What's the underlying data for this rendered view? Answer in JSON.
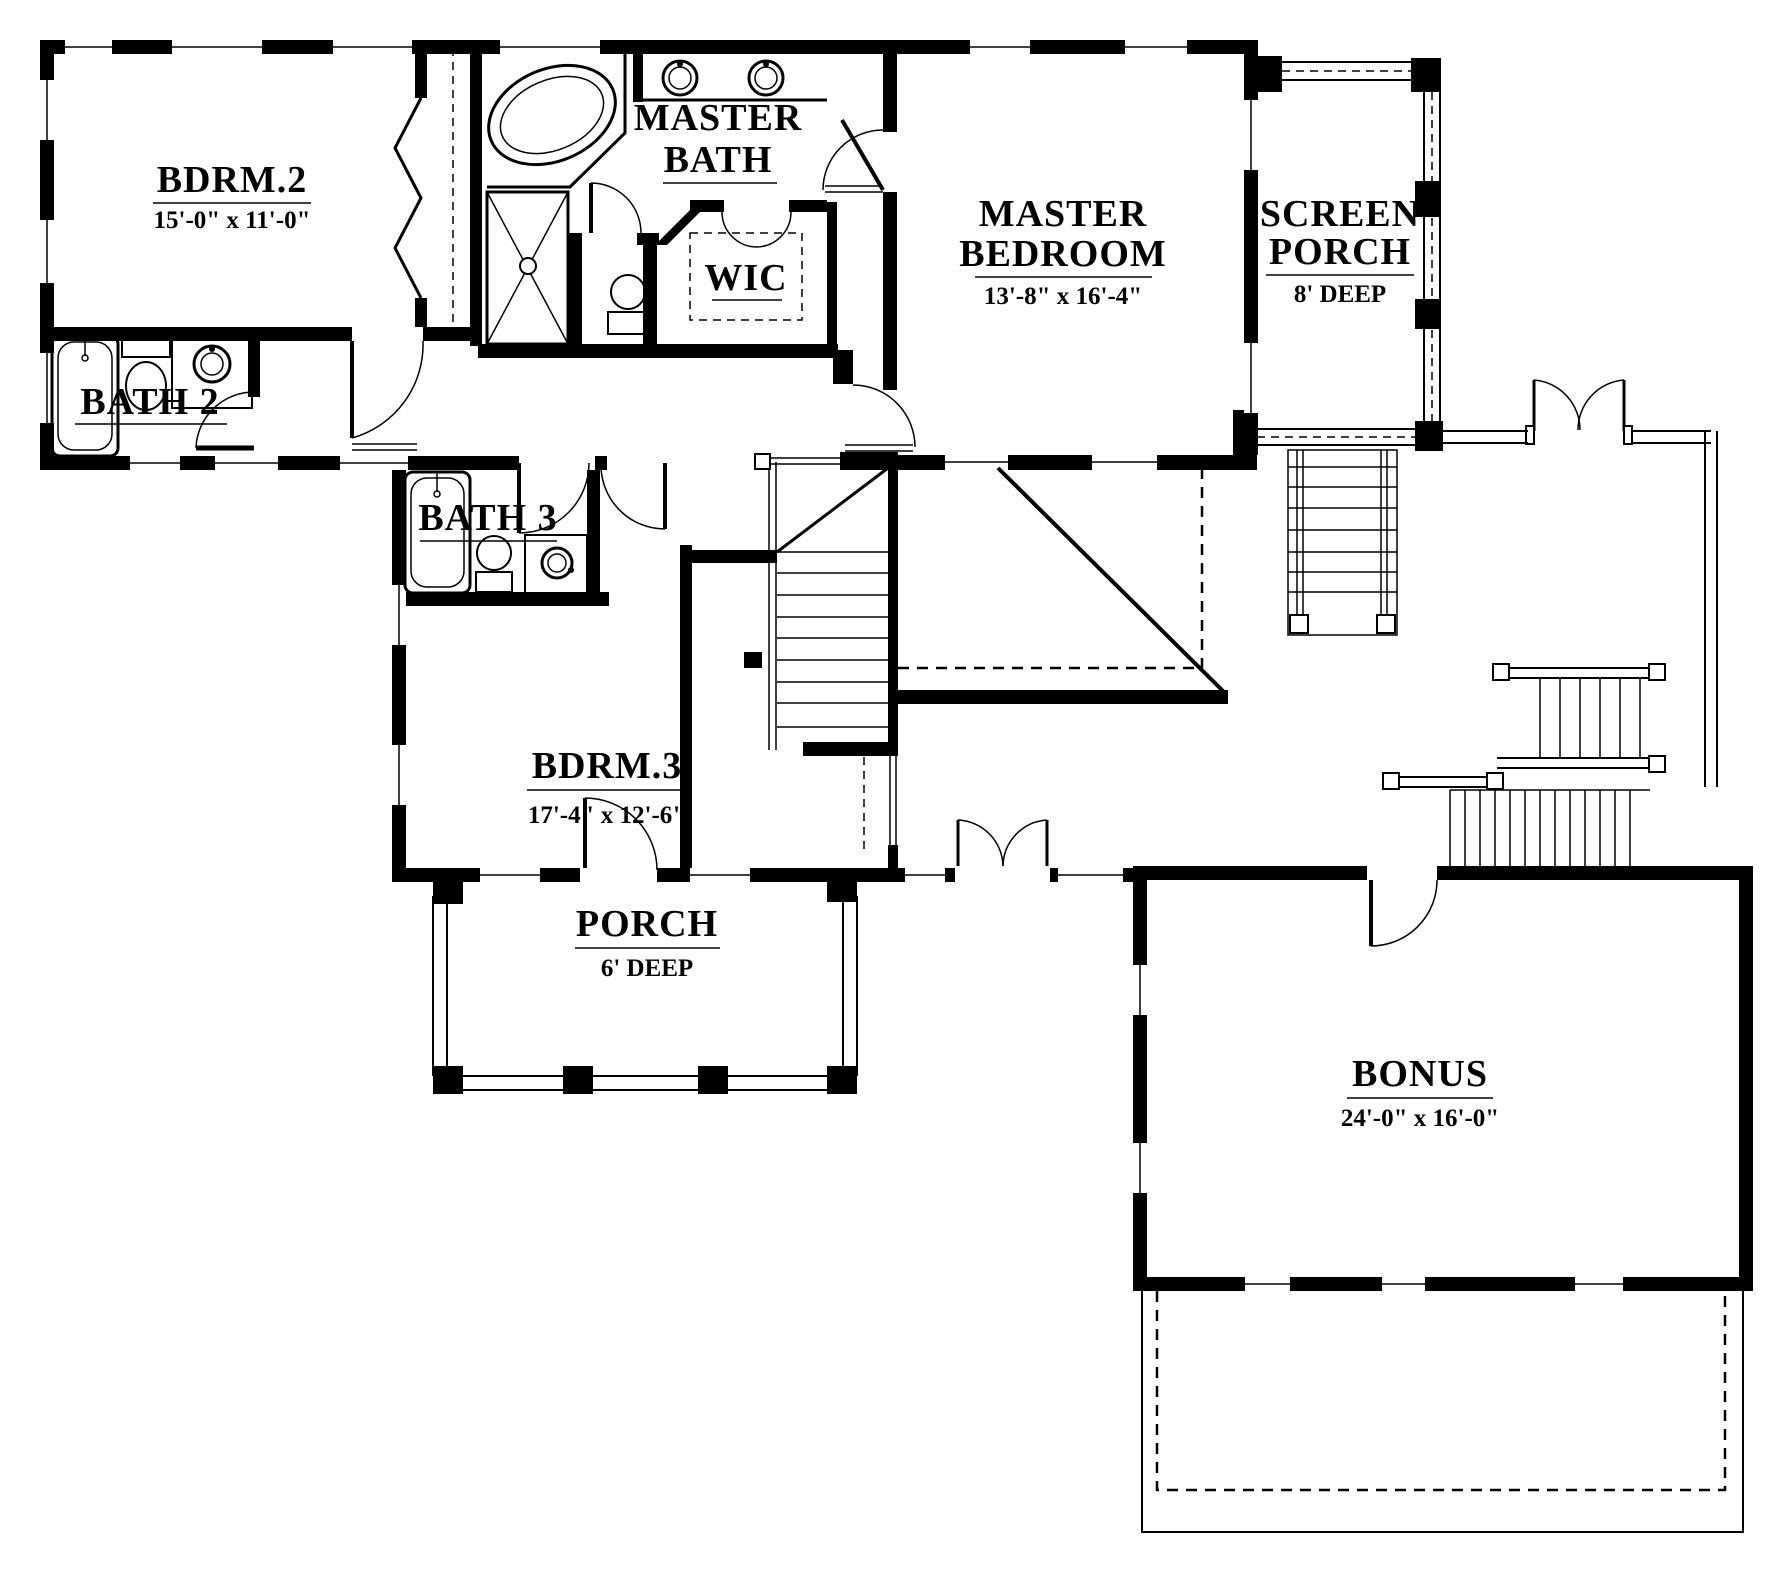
{
  "drawing": {
    "type": "architectural-floor-plan",
    "paper_color": "#ffffff",
    "ink_color": "#000000",
    "rooms": {
      "bdrm2": {
        "name": "BDRM.2",
        "dims": "15'-0\" x 11'-0\""
      },
      "bath2": {
        "name": "BATH 2"
      },
      "master_bath": {
        "line1": "MASTER",
        "line2": "BATH"
      },
      "wic": {
        "name": "WIC"
      },
      "master_bedroom": {
        "line1": "MASTER",
        "line2": "BEDROOM",
        "dims": "13'-8\" x 16'-4\""
      },
      "screen_porch": {
        "line1": "SCREEN",
        "line2": "PORCH",
        "dims": "8' DEEP"
      },
      "bath3": {
        "name": "BATH 3"
      },
      "bdrm3": {
        "name": "BDRM.3",
        "dims": "17'-4\" x 12'-6\""
      },
      "porch": {
        "name": "PORCH",
        "dims": "6' DEEP"
      },
      "bonus": {
        "name": "BONUS",
        "dims": "24'-0\" x 16'-0\""
      }
    }
  }
}
